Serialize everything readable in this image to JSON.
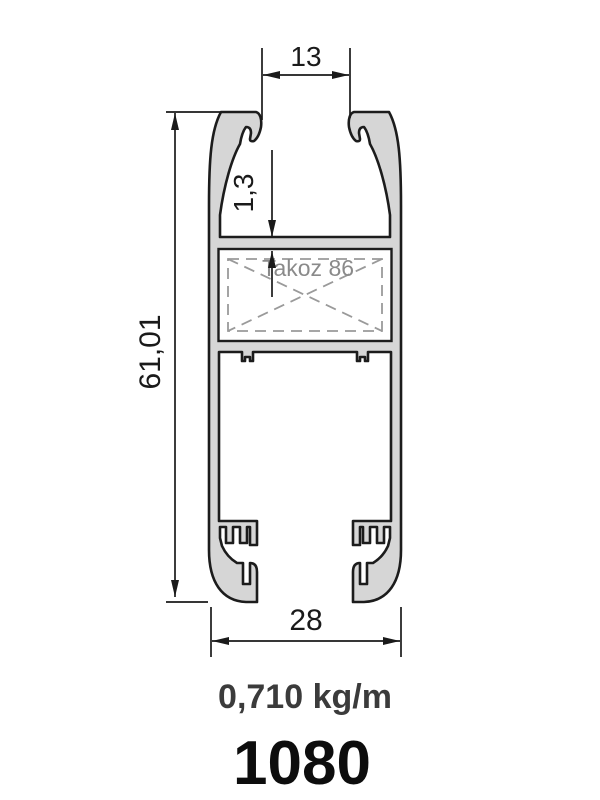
{
  "drawing": {
    "title": "aluminum profile cross-section technical drawing",
    "dimensions": {
      "top_slot_width": "13",
      "wall_thickness": "1,3",
      "overall_height": "61,01",
      "overall_width": "28"
    },
    "insert_label": "Takoz 86",
    "weight": "0,710 kg/m",
    "part_number": "1080"
  },
  "colors": {
    "background": "#ffffff",
    "profile_fill": "#d6d6d6",
    "outline": "#1c1c1c",
    "dashed_lines": "#9a9a9a",
    "dimension_lines": "#1a1a1a",
    "insert_label_text": "#8a8a8a",
    "weight_text": "#3b3b3b",
    "part_number_text": "#0d0d0d"
  }
}
